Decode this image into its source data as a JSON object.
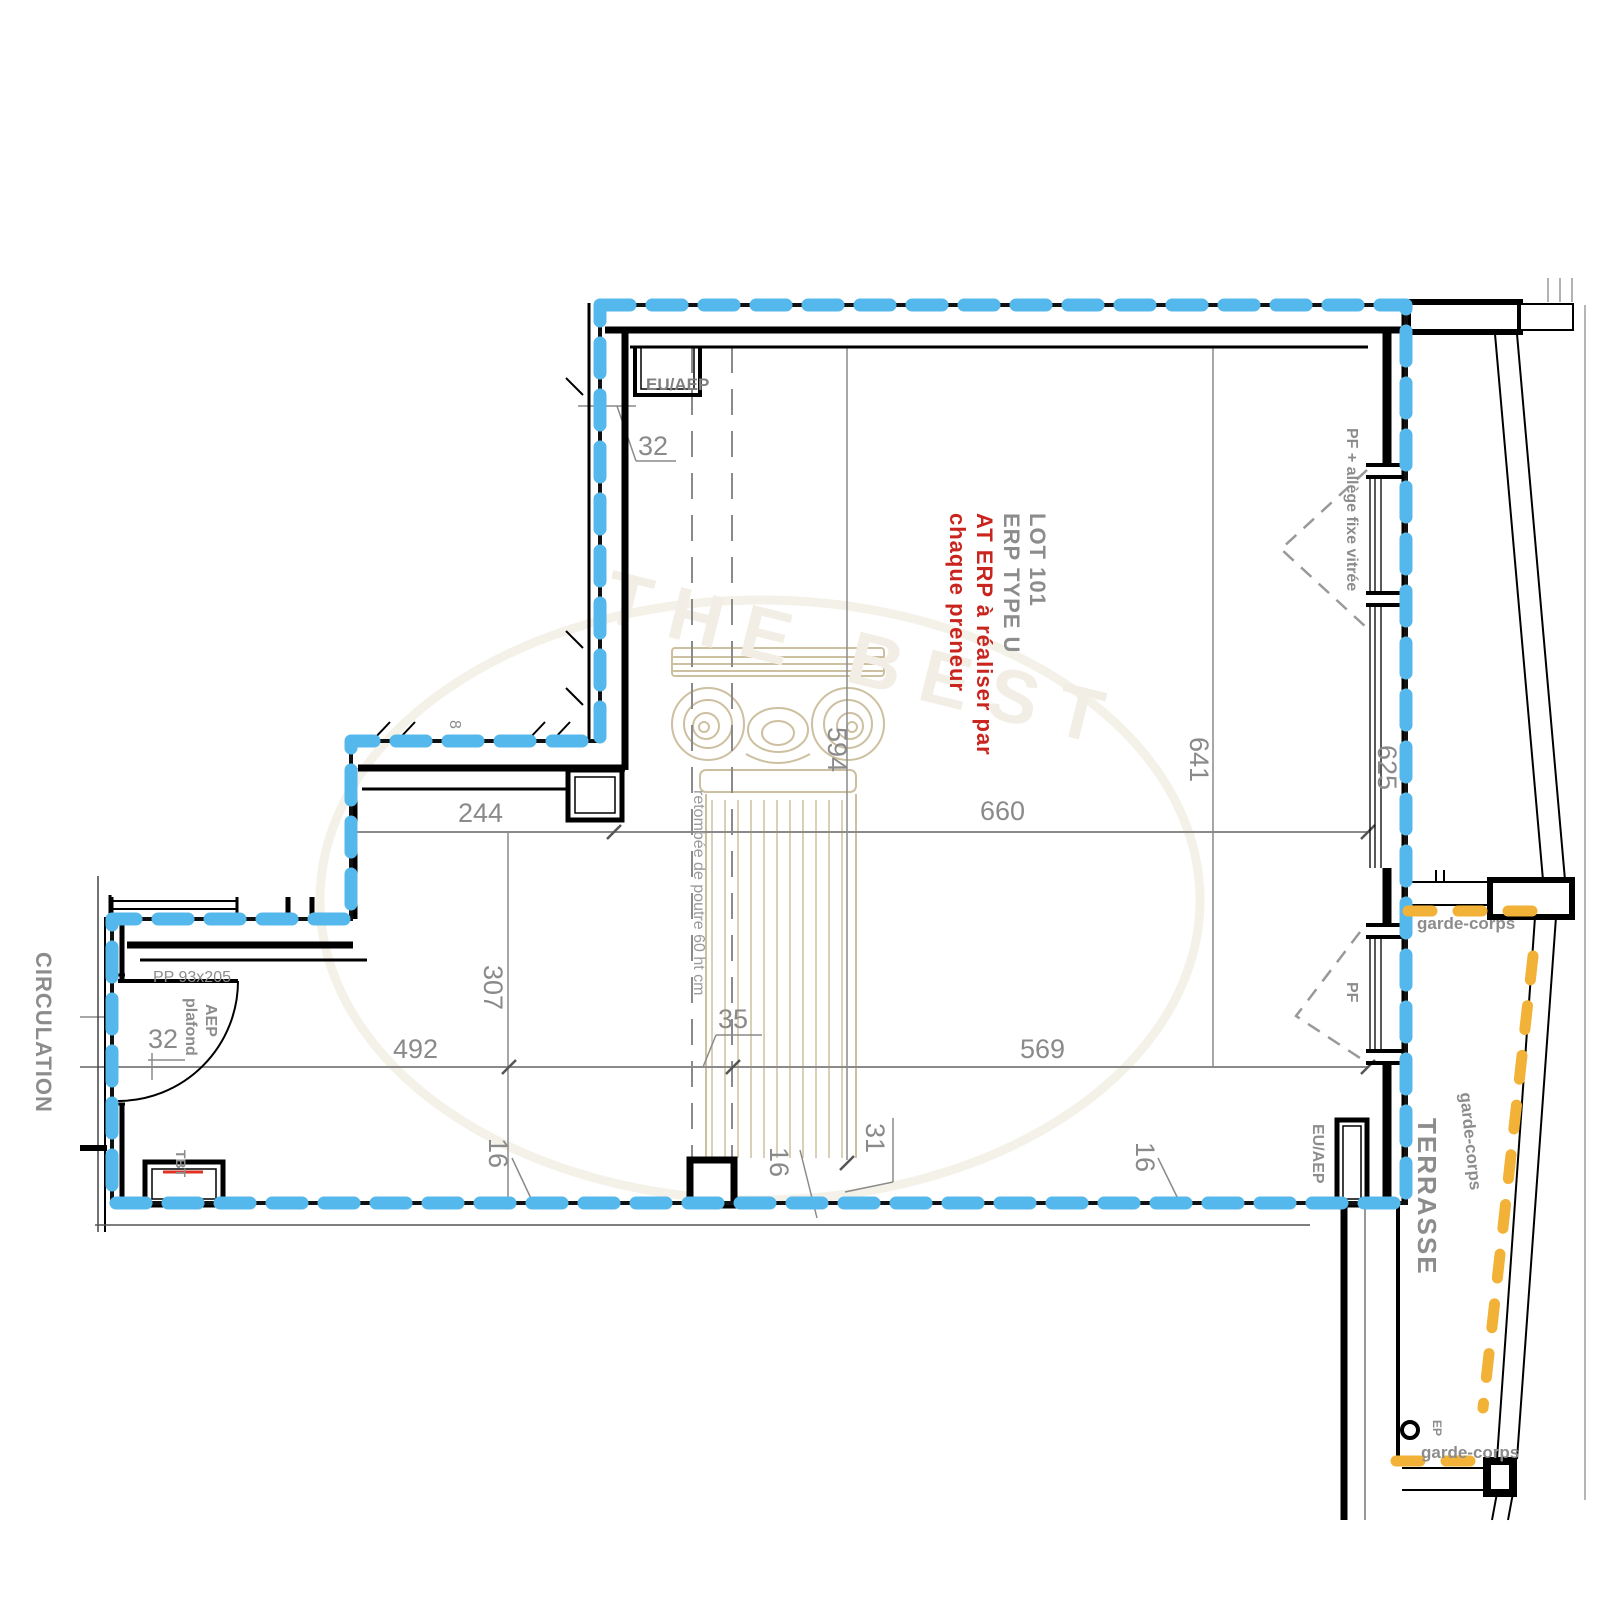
{
  "drawing": {
    "room_labels": {
      "lot_line1": "LOT 101",
      "lot_line2": "ERP TYPE U",
      "lot_note_line1": "AT ERP à réaliser par",
      "lot_note_line2": "chaque preneur",
      "circulation": "CIRCULATION",
      "terrasse": "TERRASSE"
    },
    "annotations": {
      "garde_corps_upper": "garde-corps",
      "garde_corps_diagonal": "garde-corps",
      "garde_corps_lower": "garde-corps",
      "pf_allege": "PF + allège fixe vitrée",
      "pf": "PF",
      "eu_aep_top": "EU/AEP",
      "eu_aep_right": "EU/AEP",
      "aep_line1": "AEP",
      "aep_line2": "plafond",
      "door": "PP 93x205",
      "tbt": "TBT",
      "ep": "EP",
      "beam_note": "retombée de poutre 60 ht cm"
    },
    "dimensions": {
      "top_niche_offset": "32",
      "step_width": "244",
      "step_small": "8",
      "beam_length": "594",
      "room_width_upper": "660",
      "room_depth_right": "641",
      "terrace_depth": "625",
      "left_lower_depth": "307",
      "door_offset": "32",
      "lower_left_width": "492",
      "beam_width": "35",
      "lower_right_width": "569",
      "pier_left": "16",
      "pier_mid": "16",
      "pier_right": "16",
      "beam_axis_offset": "31"
    },
    "watermark_text": "THE BEST",
    "colors": {
      "lot_boundary": "#55b8ec",
      "garde_corps": "#f2b237",
      "dimension_gray": "#8a8a8a",
      "label_gray": "#8c8c8c",
      "note_red": "#c9241e",
      "watermark_beige": "#cdc0a0",
      "watermark_white": "#f2eee5"
    }
  }
}
